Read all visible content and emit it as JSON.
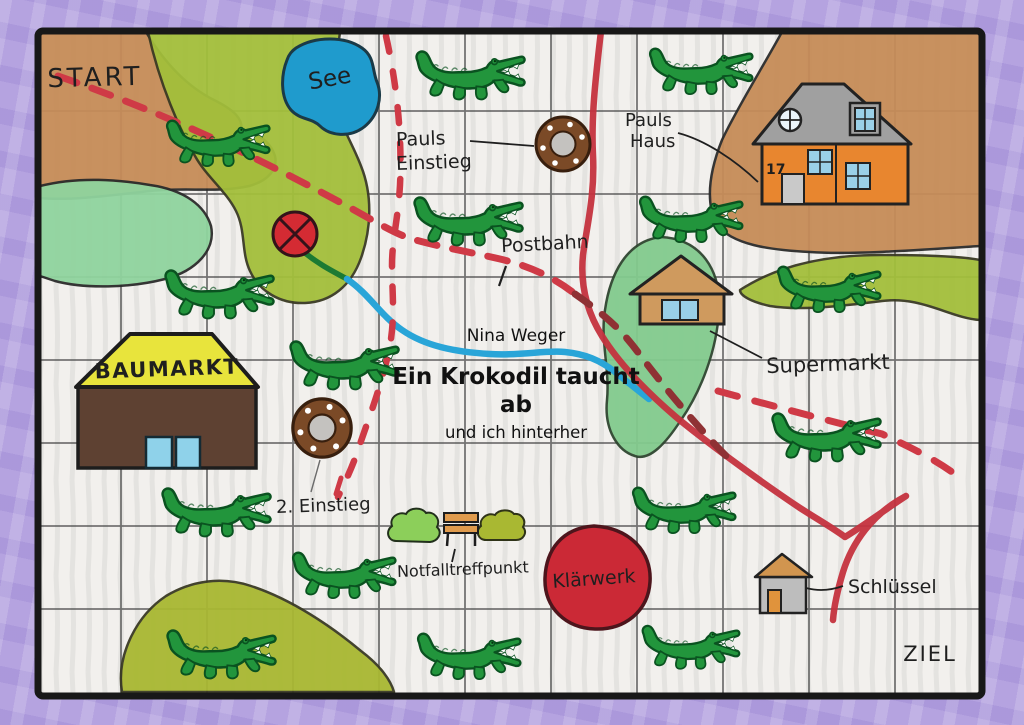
{
  "board": {
    "start": "START",
    "ziel": "ZIEL"
  },
  "book": {
    "author": "Nina Weger",
    "title_line1": "Ein Krokodil taucht",
    "title_line2": "ab",
    "subtitle": "und ich hinterher"
  },
  "locations": {
    "see": "See",
    "pauls_einstieg_line1": "Pauls",
    "pauls_einstieg_line2": "Einstieg",
    "pauls_haus_line1": "Pauls",
    "pauls_haus_line2": "Haus",
    "house_number": "17",
    "postbahn": "Postbahn",
    "baumarkt": "BAUMARKT",
    "supermarkt": "Supermarkt",
    "zweiter_einstieg": "2. Einstieg",
    "notfalltreffpunkt": "Notfalltreffpunkt",
    "klaerwerk": "Klärwerk",
    "schluessel": "Schlüssel"
  },
  "counts": {
    "crocodiles": 15,
    "manholes": 2,
    "grid_rows": 8,
    "grid_columns": 11
  },
  "colors": {
    "border_purple": "#b5a3e0",
    "paper": "#f2f0ed",
    "terrain_tan": "#c68c58",
    "terrain_olive": "#a3bf3b",
    "terrain_light_green": "#90d49e",
    "supermarkt_green": "#83cb8e",
    "lake_blue": "#1f9bcd",
    "road_red": "#c4323e",
    "dashed_red": "#cf3a46",
    "dashed_maroon": "#8f3134",
    "underground_blue": "#29a5d8",
    "crocodile_green": "#22953c",
    "klaerwerk_red": "#cb2936",
    "baumarkt_yellow": "#e8e43c",
    "baumarkt_brown": "#5e4132",
    "house_orange": "#e8862f",
    "roof_gray": "#a0a0a0",
    "manhole_brown": "#7b4a27"
  }
}
